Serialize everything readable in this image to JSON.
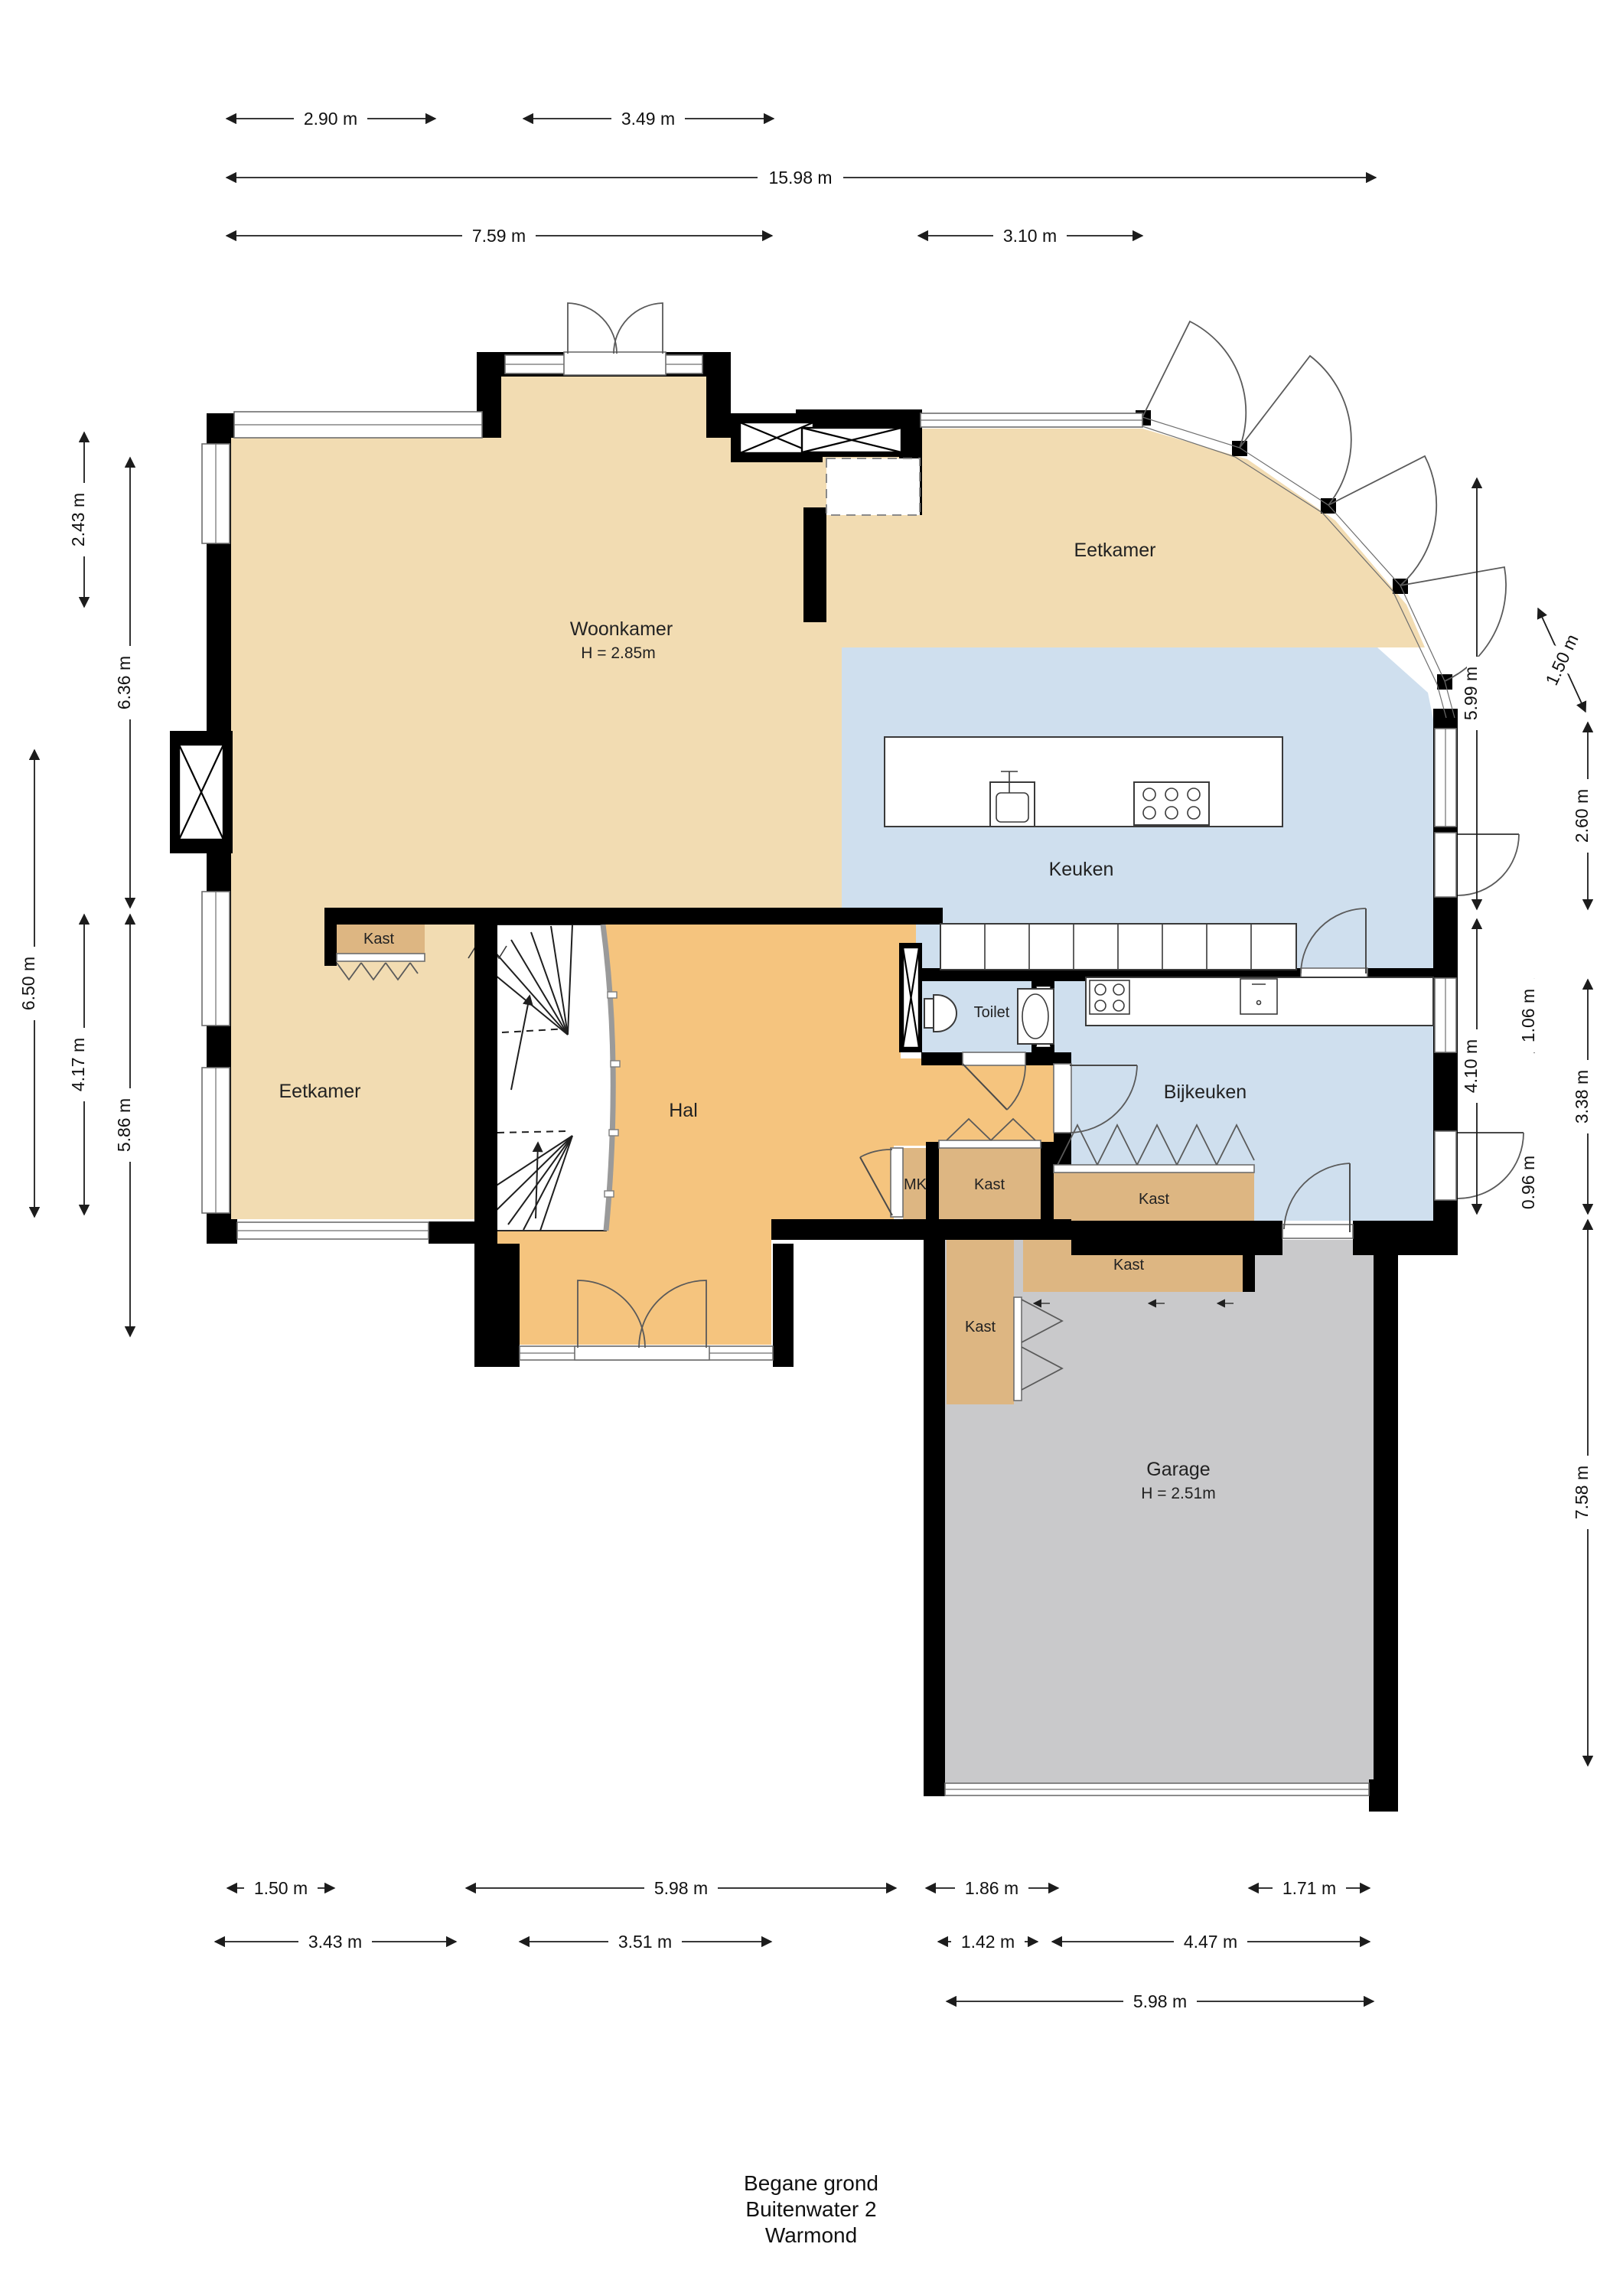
{
  "title": {
    "line1": "Begane grond",
    "line2": "Buitenwater 2",
    "line3": "Warmond"
  },
  "rooms": {
    "woonkamer": "Woonkamer",
    "woonkamer_h": "H = 2.85m",
    "eetkamer_top": "Eetkamer",
    "eetkamer_left": "Eetkamer",
    "keuken": "Keuken",
    "bijkeuken": "Bijkeuken",
    "toilet": "Toilet",
    "hal": "Hal",
    "mk": "MK",
    "kast_hal": "Kast",
    "kast_mk_side": "Kast",
    "kast_bijkeuken": "Kast",
    "kast_garage_top": "Kast",
    "kast_garage_left": "Kast",
    "garage": "Garage",
    "garage_h": "H = 2.51m"
  },
  "dims": [
    "2.90 m",
    "3.49 m",
    "15.98 m",
    "7.59 m",
    "3.10 m",
    "2.43 m",
    "6.36 m",
    "6.50 m",
    "4.17 m",
    "5.86 m",
    "5.99 m",
    "2.60 m",
    "1.50 m",
    "4.10 m",
    "1.06 m",
    "3.38 m",
    "0.96 m",
    "7.58 m",
    "1.50 m",
    "5.98 m",
    "1.86 m",
    "1.71 m",
    "3.43 m",
    "3.51 m",
    "1.42 m",
    "4.47 m",
    "5.98 m"
  ],
  "colors": {
    "floor_tan": "#f2dcb2",
    "floor_orange": "#f5c47e",
    "floor_blue": "#cfdfee",
    "floor_gray": "#c9c9cb",
    "kast_tan": "#ddb682",
    "wall": "#000000"
  }
}
